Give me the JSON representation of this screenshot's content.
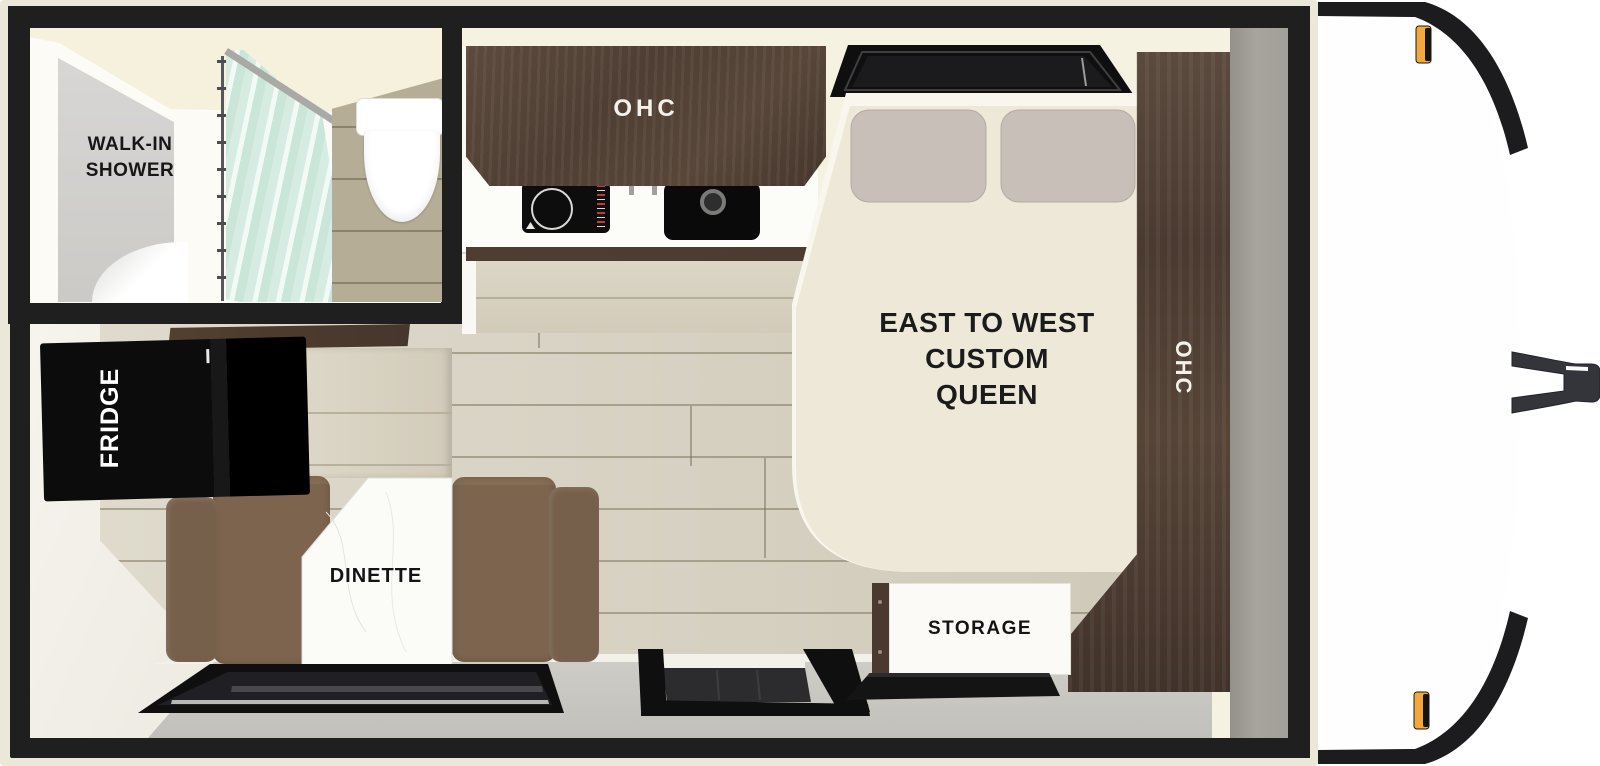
{
  "floorplan": {
    "type": "travel-trailer-floorplan",
    "labels": {
      "shower_line1": "WALK-IN",
      "shower_line2": "SHOWER",
      "kitchen_ohc": "OHC",
      "fridge": "FRIDGE",
      "dinette": "DINETTE",
      "bed_line1": "EAST TO WEST",
      "bed_line2": "CUSTOM",
      "bed_line3": "QUEEN",
      "bedside_ohc": "OHC",
      "storage": "STORAGE"
    },
    "colors": {
      "wall_black": "#1f1f1f",
      "trim_cream": "#ece8d9",
      "interior_cream": "#f5f2e2",
      "floor_plank": "#d8d2c1",
      "cabinet_wood": "#54433a",
      "bed_spread": "#ede8d7",
      "pillow_gray": "#c8bfb8",
      "bench_brown": "#7c644e",
      "bathroom_floor": "#b5ad96",
      "shower_glass": "#d5ece1",
      "front_wall_gray": "#a29f99",
      "floor_edge_gray": "#c8c6c0",
      "marker_amber": "#f2a83c",
      "appliance_black": "#0d0d0d"
    }
  }
}
